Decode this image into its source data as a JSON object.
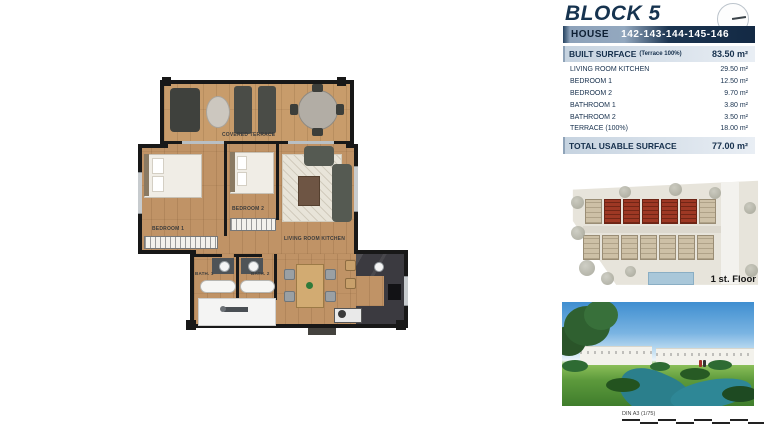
{
  "header": {
    "block_title": "BLOCK 5",
    "house_label": "HOUSE",
    "house_numbers": "142-143-144-145-146"
  },
  "surface_table": {
    "built": {
      "label": "BUILT SURFACE",
      "sublabel": "(Terrace 100%)",
      "value": "83.50 m²"
    },
    "rows": [
      {
        "label": "LIVING ROOM KITCHEN",
        "value": "29.50 m²"
      },
      {
        "label": "BEDROOM 1",
        "value": "12.50 m²"
      },
      {
        "label": "BEDROOM 2",
        "value": "9.70 m²"
      },
      {
        "label": "BATHROOM 1",
        "value": "3.80 m²"
      },
      {
        "label": "BATHROOM 2",
        "value": "3.50 m²"
      },
      {
        "label": "TERRACE (100%)",
        "value": "18.00 m²"
      }
    ],
    "total": {
      "label": "TOTAL USABLE SURFACE",
      "value": "77.00 m²"
    }
  },
  "floor_plan": {
    "rooms": {
      "covered_terrace": "COVERED TERRACE",
      "bedroom_1": "BEDROOM 1",
      "bedroom_2": "BEDROOM 2",
      "living_room_kitchen": "LIVING ROOM KITCHEN",
      "bath_1": "BATH. 1",
      "bath_2": "BATH. 2"
    }
  },
  "site_plan": {
    "caption": "1 st. Floor"
  },
  "scale_bar": {
    "label": "DIN A3 (1/75)"
  },
  "colors": {
    "navy": "#16334f",
    "bar_light": "#c6d3e0",
    "wood": "#c09366",
    "wall": "#181818",
    "highlight_red": "#9e3824"
  }
}
